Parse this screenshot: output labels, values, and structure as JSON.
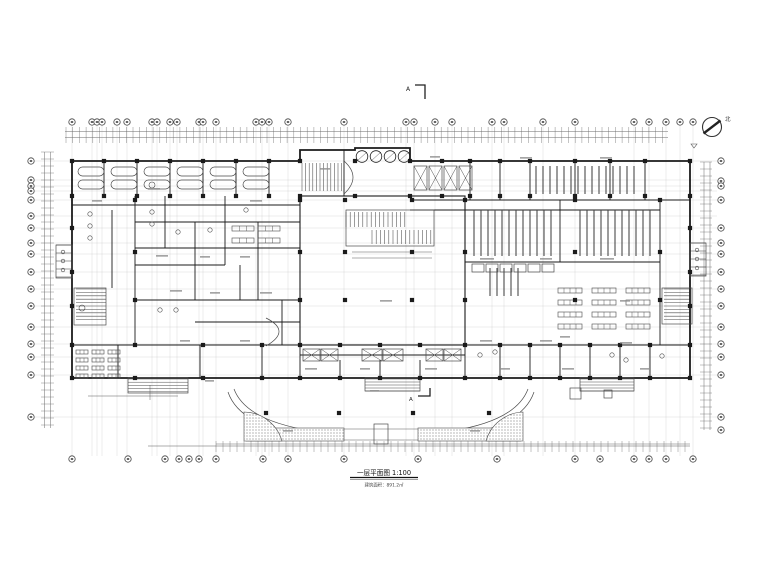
{
  "meta": {
    "background": "#ffffff",
    "ink": "#1b1b1b",
    "mid": "#4a4a4a",
    "dim": "#6a6a6a",
    "grid": "#c9c9c9",
    "smudge": "#8f8f8f"
  },
  "annotations": {
    "title_line1": "一层平面图 1:100",
    "title_line2": "建筑面积：891.2㎡",
    "north_label": "北",
    "section_label": "A"
  },
  "grid": {
    "top_y": 122,
    "bottom_y": 459,
    "left_x": 31,
    "right_x": 721,
    "top_xs": [
      72,
      92,
      97,
      102,
      117,
      127,
      152,
      157,
      170,
      177,
      199,
      203,
      216,
      256,
      262,
      269,
      288,
      344,
      406,
      414,
      435,
      452,
      492,
      504,
      543,
      575,
      634,
      649,
      666,
      680,
      693
    ],
    "bottom_xs": [
      72,
      128,
      165,
      179,
      189,
      199,
      216,
      263,
      288,
      344,
      418,
      497,
      575,
      600,
      634,
      649,
      666,
      693
    ],
    "left_ys": [
      161,
      180,
      186,
      191,
      200,
      216,
      228,
      243,
      254,
      272,
      289,
      306,
      327,
      344,
      357,
      375,
      417
    ],
    "right_ys": [
      161,
      181,
      186,
      200,
      228,
      243,
      254,
      272,
      289,
      306,
      327,
      344,
      357,
      375,
      417,
      430
    ],
    "dim_lines": [
      [
        65,
        131.5,
        668,
        131.5
      ],
      [
        65,
        137.5,
        668,
        137.5
      ],
      [
        216,
        444,
        690,
        444
      ],
      [
        44.5,
        152,
        44.5,
        428
      ],
      [
        50.5,
        152,
        50.5,
        428
      ],
      [
        704,
        162,
        704,
        430
      ],
      [
        710,
        162,
        710,
        430
      ]
    ]
  },
  "plan": {
    "outline": "M72,161 H300 V150 H355 V148 H410 V161 H690 V378 H72 Z",
    "courtyard": [
      300,
      196,
      165,
      149
    ],
    "wall_lines": [
      [
        104,
        161,
        104,
        196
      ],
      [
        137,
        161,
        137,
        196
      ],
      [
        170,
        161,
        170,
        196
      ],
      [
        203,
        161,
        203,
        196
      ],
      [
        236,
        161,
        236,
        196
      ],
      [
        269,
        161,
        269,
        196
      ],
      [
        72,
        205,
        300,
        205
      ],
      [
        300,
        196,
        355,
        196
      ],
      [
        344,
        150,
        344,
        196
      ],
      [
        470,
        161,
        470,
        200
      ],
      [
        500,
        161,
        500,
        200
      ],
      [
        530,
        161,
        530,
        200
      ],
      [
        575,
        161,
        575,
        200
      ],
      [
        610,
        161,
        610,
        200
      ],
      [
        645,
        161,
        645,
        200
      ],
      [
        410,
        200,
        690,
        200
      ],
      [
        410,
        210,
        660,
        210
      ],
      [
        135,
        196,
        135,
        345
      ],
      [
        112,
        210,
        112,
        288
      ],
      [
        660,
        200,
        660,
        345
      ],
      [
        72,
        345,
        690,
        345
      ],
      [
        300,
        355,
        465,
        355
      ],
      [
        118,
        345,
        118,
        378
      ],
      [
        200,
        345,
        200,
        378
      ],
      [
        262,
        345,
        262,
        378
      ],
      [
        300,
        345,
        300,
        378
      ],
      [
        340,
        360,
        340,
        378
      ],
      [
        380,
        360,
        380,
        378
      ],
      [
        420,
        360,
        420,
        378
      ],
      [
        465,
        345,
        465,
        378
      ],
      [
        500,
        345,
        500,
        378
      ],
      [
        530,
        345,
        530,
        378
      ],
      [
        560,
        345,
        560,
        378
      ],
      [
        590,
        345,
        590,
        378
      ],
      [
        620,
        345,
        620,
        378
      ],
      [
        650,
        345,
        650,
        378
      ],
      [
        135,
        222,
        300,
        222
      ],
      [
        135,
        248,
        300,
        248
      ],
      [
        135,
        265,
        225,
        265
      ],
      [
        135,
        300,
        300,
        300
      ],
      [
        195,
        322,
        300,
        322
      ],
      [
        165,
        196,
        165,
        248
      ],
      [
        195,
        222,
        195,
        300
      ],
      [
        225,
        196,
        225,
        265
      ],
      [
        258,
        222,
        258,
        300
      ],
      [
        282,
        300,
        282,
        345
      ],
      [
        240,
        265,
        240,
        300
      ],
      [
        465,
        196,
        465,
        345
      ],
      [
        560,
        200,
        560,
        262
      ],
      [
        465,
        262,
        660,
        262
      ]
    ],
    "thin_lines": [
      [
        344,
        429,
        418,
        429
      ],
      [
        344,
        440,
        418,
        440
      ],
      [
        352,
        252,
        432,
        252
      ],
      [
        352,
        258,
        432,
        258
      ],
      [
        357,
        161,
        367,
        152
      ],
      [
        371,
        161,
        381,
        152
      ],
      [
        385,
        161,
        395,
        152
      ],
      [
        399,
        161,
        409,
        152
      ],
      [
        148,
        446,
        690,
        446
      ],
      [
        88,
        396,
        178,
        396
      ],
      [
        150,
        385,
        150,
        400
      ]
    ],
    "rects": [
      [
        74,
        288,
        32,
        37
      ],
      [
        662,
        288,
        30,
        36
      ],
      [
        346,
        210,
        88,
        36
      ],
      [
        56,
        245,
        16,
        33
      ],
      [
        690,
        243,
        16,
        33
      ],
      [
        128,
        378,
        60,
        15
      ],
      [
        365,
        378,
        55,
        13
      ],
      [
        580,
        378,
        54,
        13
      ],
      [
        472,
        264,
        12,
        8
      ],
      [
        486,
        264,
        12,
        8
      ],
      [
        500,
        264,
        12,
        8
      ],
      [
        514,
        264,
        12,
        8
      ],
      [
        528,
        264,
        12,
        8
      ],
      [
        542,
        264,
        12,
        8
      ],
      [
        570,
        388,
        11,
        11
      ],
      [
        604,
        390,
        8,
        8
      ],
      [
        374,
        424,
        14,
        20
      ]
    ],
    "xboxes": [
      [
        414,
        166,
        13,
        24
      ],
      [
        429,
        166,
        13,
        24
      ],
      [
        444,
        166,
        13,
        24
      ],
      [
        459,
        166,
        13,
        24
      ],
      [
        303,
        349,
        17,
        12
      ],
      [
        321,
        349,
        17,
        12
      ],
      [
        362,
        349,
        20,
        12
      ],
      [
        383,
        349,
        20,
        12
      ],
      [
        426,
        349,
        17,
        12
      ],
      [
        444,
        349,
        17,
        12
      ]
    ],
    "stadiums": [
      [
        78,
        167,
        26,
        9
      ],
      [
        78,
        180,
        26,
        9
      ],
      [
        111,
        167,
        26,
        9
      ],
      [
        111,
        180,
        26,
        9
      ],
      [
        144,
        167,
        26,
        9
      ],
      [
        144,
        180,
        26,
        9
      ],
      [
        177,
        167,
        26,
        9
      ],
      [
        177,
        180,
        26,
        9
      ],
      [
        210,
        167,
        26,
        9
      ],
      [
        210,
        180,
        26,
        9
      ],
      [
        243,
        167,
        26,
        9
      ],
      [
        243,
        180,
        26,
        9
      ]
    ],
    "stacks": [
      {
        "x": 474,
        "y": 210,
        "h": 46,
        "n": 12,
        "p": 7
      },
      {
        "x": 580,
        "y": 210,
        "h": 46,
        "n": 11,
        "p": 7
      },
      {
        "x": 536,
        "y": 166,
        "h": 28,
        "n": 15,
        "p": 7
      },
      {
        "x": 490,
        "y": 268,
        "h": 28,
        "n": 5,
        "p": 7
      }
    ],
    "combs": [
      {
        "x": 66,
        "y": 127,
        "w": 602,
        "h": 16,
        "p": 6.7,
        "d": "v",
        "c": "dim",
        "sw": 0.4
      },
      {
        "x": 216,
        "y": 441,
        "w": 474,
        "h": 11,
        "p": 7,
        "d": "v",
        "c": "dim",
        "sw": 0.4
      },
      {
        "x": 41,
        "y": 152,
        "w": 13,
        "h": 276,
        "p": 7,
        "d": "h",
        "c": "dim",
        "sw": 0.4
      },
      {
        "x": 700,
        "y": 162,
        "w": 12,
        "h": 268,
        "p": 7,
        "d": "h",
        "c": "dim",
        "sw": 0.4
      },
      {
        "x": 302,
        "y": 163,
        "w": 40,
        "h": 28,
        "p": 3.6,
        "d": "v",
        "c": "mid",
        "sw": 0.55
      },
      {
        "x": 346,
        "y": 212,
        "w": 60,
        "h": 15,
        "p": 4.2,
        "d": "v",
        "c": "mid",
        "sw": 0.55
      },
      {
        "x": 372,
        "y": 230,
        "w": 60,
        "h": 14,
        "p": 4.2,
        "d": "v",
        "c": "mid",
        "sw": 0.55
      },
      {
        "x": 76,
        "y": 289,
        "w": 30,
        "h": 33,
        "p": 3.4,
        "d": "h",
        "c": "mid",
        "sw": 0.55
      },
      {
        "x": 664,
        "y": 289,
        "w": 26,
        "h": 33,
        "p": 3.4,
        "d": "h",
        "c": "mid",
        "sw": 0.55
      },
      {
        "x": 128,
        "y": 379,
        "w": 60,
        "h": 13,
        "p": 3.2,
        "d": "h",
        "c": "mid",
        "sw": 0.5
      },
      {
        "x": 365,
        "y": 379,
        "w": 55,
        "h": 12,
        "p": 3,
        "d": "h",
        "c": "mid",
        "sw": 0.5
      },
      {
        "x": 580,
        "y": 379,
        "w": 54,
        "h": 12,
        "p": 3,
        "d": "h",
        "c": "mid",
        "sw": 0.5
      },
      {
        "x": 56,
        "y": 245,
        "w": 16,
        "h": 33,
        "p": 8,
        "d": "h",
        "c": "mid",
        "sw": 0.55
      },
      {
        "x": 690,
        "y": 243,
        "w": 16,
        "h": 33,
        "p": 8,
        "d": "h",
        "c": "mid",
        "sw": 0.55
      }
    ],
    "tables": [
      [
        558,
        288,
        24,
        5,
        4
      ],
      [
        592,
        288,
        24,
        5,
        4
      ],
      [
        626,
        288,
        24,
        5,
        4
      ],
      [
        558,
        300,
        24,
        5,
        4
      ],
      [
        592,
        300,
        24,
        5,
        4
      ],
      [
        626,
        300,
        24,
        5,
        4
      ],
      [
        558,
        312,
        24,
        5,
        4
      ],
      [
        592,
        312,
        24,
        5,
        4
      ],
      [
        626,
        312,
        24,
        5,
        4
      ],
      [
        558,
        324,
        24,
        5,
        4
      ],
      [
        592,
        324,
        24,
        5,
        4
      ],
      [
        626,
        324,
        24,
        5,
        4
      ],
      [
        76,
        350,
        12,
        4,
        3
      ],
      [
        92,
        350,
        12,
        4,
        3
      ],
      [
        108,
        350,
        12,
        4,
        3
      ],
      [
        76,
        358,
        12,
        4,
        3
      ],
      [
        92,
        358,
        12,
        4,
        3
      ],
      [
        108,
        358,
        12,
        4,
        3
      ],
      [
        76,
        366,
        12,
        4,
        3
      ],
      [
        92,
        366,
        12,
        4,
        3
      ],
      [
        108,
        366,
        12,
        4,
        3
      ],
      [
        76,
        374,
        12,
        4,
        3
      ],
      [
        92,
        374,
        12,
        4,
        3
      ],
      [
        108,
        374,
        12,
        4,
        3
      ],
      [
        232,
        226,
        22,
        5,
        3
      ],
      [
        258,
        226,
        22,
        5,
        3
      ],
      [
        232,
        238,
        22,
        5,
        3
      ],
      [
        258,
        238,
        22,
        5,
        3
      ]
    ],
    "circles": [
      [
        63,
        252,
        1.8
      ],
      [
        63,
        261,
        1.8
      ],
      [
        63,
        270,
        1.8
      ],
      [
        697,
        250,
        1.8
      ],
      [
        697,
        259,
        1.8
      ],
      [
        697,
        268,
        1.8
      ],
      [
        90,
        214,
        2.2
      ],
      [
        90,
        226,
        2.2
      ],
      [
        90,
        238,
        2.2
      ],
      [
        152,
        212,
        2.2
      ],
      [
        152,
        224,
        2.2
      ],
      [
        178,
        232,
        2.2
      ],
      [
        210,
        230,
        2.2
      ],
      [
        246,
        210,
        2.2
      ],
      [
        160,
        310,
        2.2
      ],
      [
        176,
        310,
        2.2
      ],
      [
        480,
        355,
        2.2
      ],
      [
        495,
        352,
        2.2
      ],
      [
        612,
        355,
        2.2
      ],
      [
        626,
        360,
        2.2
      ],
      [
        662,
        356,
        2.2
      ],
      [
        152,
        185,
        3
      ],
      [
        82,
        308,
        3
      ]
    ],
    "portico_circles": [
      [
        362,
        156.5,
        5.8
      ],
      [
        376,
        156.5,
        5.8
      ],
      [
        390,
        156.5,
        5.8
      ],
      [
        404,
        156.5,
        5.8
      ]
    ],
    "arcs": [
      "M228,392 Q240,428 316,438",
      "M234,389 Q246,421 313,431",
      "M448,438 Q522,428 534,392",
      "M451,431 Q516,421 528,389",
      "M344,194 Q362,177 344,161",
      "M266,318 Q292,331 266,346"
    ],
    "stip_rects": [
      [
        246,
        428,
        98,
        13
      ],
      [
        418,
        428,
        103,
        13
      ]
    ],
    "stip_paths": [
      "M282,441 A40,40 0 0 0 244,412 L244,441 Z",
      "M486,441 A40,40 0 0 1 523,412 L523,441 Z"
    ],
    "col_groups": [
      {
        "xs": [
          72,
          104,
          137,
          170,
          203,
          236,
          269,
          300,
          355,
          410,
          442,
          470,
          500,
          530,
          575,
          610,
          645,
          690
        ],
        "ys": [
          161,
          196
        ]
      },
      {
        "xs": [
          72,
          135,
          203,
          262,
          300,
          340,
          380,
          420,
          465,
          500,
          530,
          560,
          590,
          620,
          650,
          690
        ],
        "ys": [
          345,
          378
        ]
      },
      {
        "xs": [
          135,
          300,
          345,
          412,
          465,
          575,
          660
        ],
        "ys": [
          200,
          252,
          300
        ]
      },
      {
        "xs": [
          72,
          690
        ],
        "ys": [
          228,
          272,
          306
        ]
      },
      {
        "xs": [
          266,
          339,
          413,
          489
        ],
        "ys": [
          413
        ]
      }
    ],
    "smudges": [
      [
        148,
        188,
        12
      ],
      [
        92,
        200,
        10
      ],
      [
        250,
        200,
        12
      ],
      [
        320,
        168,
        10
      ],
      [
        430,
        156,
        10
      ],
      [
        520,
        157,
        12
      ],
      [
        600,
        157,
        12
      ],
      [
        156,
        255,
        12
      ],
      [
        200,
        256,
        10
      ],
      [
        240,
        256,
        10
      ],
      [
        170,
        290,
        12
      ],
      [
        210,
        292,
        10
      ],
      [
        260,
        292,
        12
      ],
      [
        480,
        258,
        14
      ],
      [
        540,
        258,
        12
      ],
      [
        600,
        258,
        14
      ],
      [
        480,
        340,
        12
      ],
      [
        540,
        340,
        12
      ],
      [
        620,
        342,
        12
      ],
      [
        180,
        340,
        10
      ],
      [
        240,
        340,
        10
      ],
      [
        305,
        368,
        12
      ],
      [
        360,
        368,
        10
      ],
      [
        425,
        368,
        12
      ],
      [
        500,
        368,
        10
      ],
      [
        562,
        368,
        12
      ],
      [
        640,
        368,
        10
      ],
      [
        283,
        430,
        10
      ],
      [
        470,
        430,
        10
      ],
      [
        380,
        300,
        12
      ],
      [
        560,
        336,
        10
      ],
      [
        620,
        300,
        10
      ],
      [
        370,
        390,
        9
      ],
      [
        205,
        380,
        9
      ]
    ]
  }
}
